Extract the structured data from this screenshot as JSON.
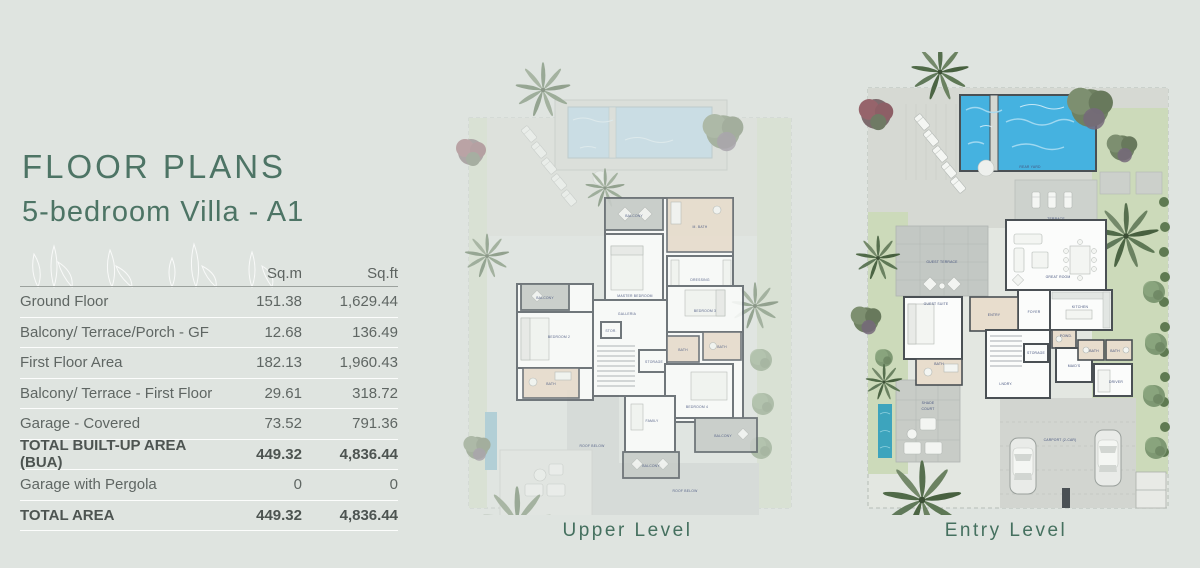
{
  "header": {
    "title": "FLOOR PLANS",
    "subtitle": "5-bedroom Villa - A1"
  },
  "table": {
    "columns": [
      "Sq.m",
      "Sq.ft"
    ],
    "rows": [
      {
        "label": "Ground Floor",
        "sqm": "151.38",
        "sqft": "1,629.44"
      },
      {
        "label": "Balcony/ Terrace/Porch - GF",
        "sqm": "12.68",
        "sqft": "136.49"
      },
      {
        "label": "First Floor Area",
        "sqm": "182.13",
        "sqft": "1,960.43"
      },
      {
        "label": "Balcony/ Terrace - First Floor",
        "sqm": "29.61",
        "sqft": "318.72"
      },
      {
        "label": "Garage - Covered",
        "sqm": "73.52",
        "sqft": "791.36"
      },
      {
        "label": "TOTAL BUILT-UP AREA (BUA)",
        "sqm": "449.32",
        "sqft": "4,836.44"
      },
      {
        "label": "Garage with Pergola",
        "sqm": "0",
        "sqft": "0"
      },
      {
        "label": "TOTAL AREA",
        "sqm": "449.32",
        "sqft": "4,836.44"
      }
    ]
  },
  "plans": {
    "upper": {
      "caption": "Upper Level",
      "labels": {
        "balcony_master": "BALCONY",
        "m_bath": "M. BATH",
        "master": "MASTER BEDROOM",
        "dressing": "DRESSING",
        "balcony_left": "BALCONY",
        "bedroom2": "BEDROOM 2",
        "bath_left": "BATH",
        "galleria": "GALLERIA",
        "stor": "STOR.",
        "storage": "STORAGE",
        "bedroom3": "BEDROOM 3",
        "bath_mid": "BATH",
        "bath_right": "BATH",
        "bedroom4": "BEDROOM 4",
        "family": "FAMILY",
        "balcony_bottom": "BALCONY",
        "balcony_right": "BALCONY",
        "roof_below_1": "ROOF BELOW",
        "roof_below_2": "ROOF BELOW"
      }
    },
    "entry": {
      "caption": "Entry Level",
      "labels": {
        "rear_yard": "REAR YARD",
        "terrace": "TERRACE",
        "guest_terrace": "GUEST TERRACE",
        "guest_suite": "GUEST SUITE",
        "bath_guest": "BATH",
        "entry": "ENTRY",
        "foyer": "FOYER",
        "great_room": "GREAT ROOM",
        "kitchen": "KITCHEN",
        "powd": "POWD.",
        "storage": "STORAGE",
        "lndry": "LNDRY.",
        "maids": "MAID'S",
        "bath_1": "BATH",
        "bath_2": "BATH",
        "driver": "DRIVER",
        "shade_court_1": "SHADE",
        "shade_court_2": "COURT",
        "carport": "CARPORT (2-CAR)"
      }
    }
  },
  "colors": {
    "background": "#dfe4e0",
    "accent_green": "#4d7465",
    "room_label_navy": "#46547e",
    "pool_blue": "#45b2e0",
    "grass_green": "#ccdaba"
  }
}
